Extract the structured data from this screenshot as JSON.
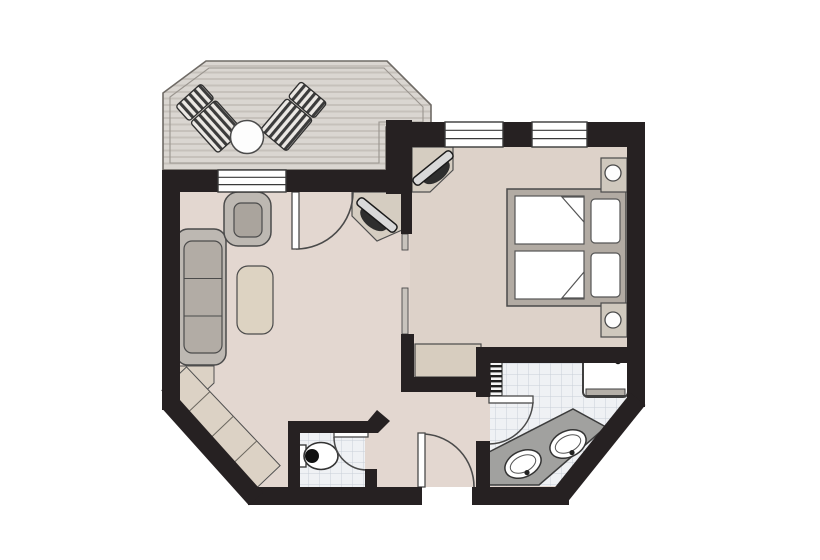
{
  "title": "apartment-floor-plan",
  "colors": {
    "background": "#ffffff",
    "wall": "#262122",
    "floor_living": "#e3d7d0",
    "floor_bedroom": "#ddd2c9",
    "deck": "#dad6d1",
    "deck_stripe": "#c6c1bb",
    "tile": "#eff1f4",
    "tile_line": "#c9cfd7",
    "furniture_gray": "#bdb8b2",
    "cushion_gray": "#b2aca5",
    "table_beige": "#ddd3c2",
    "cabinet_beige": "#dcd2c5",
    "bed_frame": "#b2aba3",
    "nightstand_beige": "#cfc8bd",
    "counter_gray": "#a1a19f",
    "fixture_white": "#ffffff",
    "outline": "#4b4b4b"
  },
  "rooms": [
    {
      "name": "terrace"
    },
    {
      "name": "living-room"
    },
    {
      "name": "bedroom"
    },
    {
      "name": "hallway"
    },
    {
      "name": "bathroom"
    },
    {
      "name": "wc"
    }
  ],
  "furniture": {
    "terrace": [
      "sun-lounger",
      "sun-lounger",
      "round-table"
    ],
    "living_room": [
      "sofa",
      "armchair",
      "coffee-table",
      "corner-tv-unit",
      "corner-shelf-unit"
    ],
    "bedroom": [
      "double-bed",
      "mattress",
      "mattress",
      "pillow",
      "pillow",
      "nightstand-with-lamp",
      "nightstand-with-lamp",
      "corner-tv-unit",
      "luggage-bench"
    ],
    "bathroom": [
      "shower",
      "double-sink-vanity",
      "towel-radiator"
    ],
    "wc": [
      "toilet"
    ]
  },
  "counts": {
    "sun_loungers": 2,
    "sinks": 2,
    "mattresses": 2,
    "pillows": 2,
    "nightstands": 2,
    "windows": 3,
    "doors": 5
  },
  "doors": [
    "terrace-door",
    "entry-door",
    "bedroom-sliding-door",
    "bathroom-door",
    "wc-door"
  ],
  "windows": [
    "living-room-window",
    "bedroom-window-1",
    "bedroom-window-2"
  ]
}
